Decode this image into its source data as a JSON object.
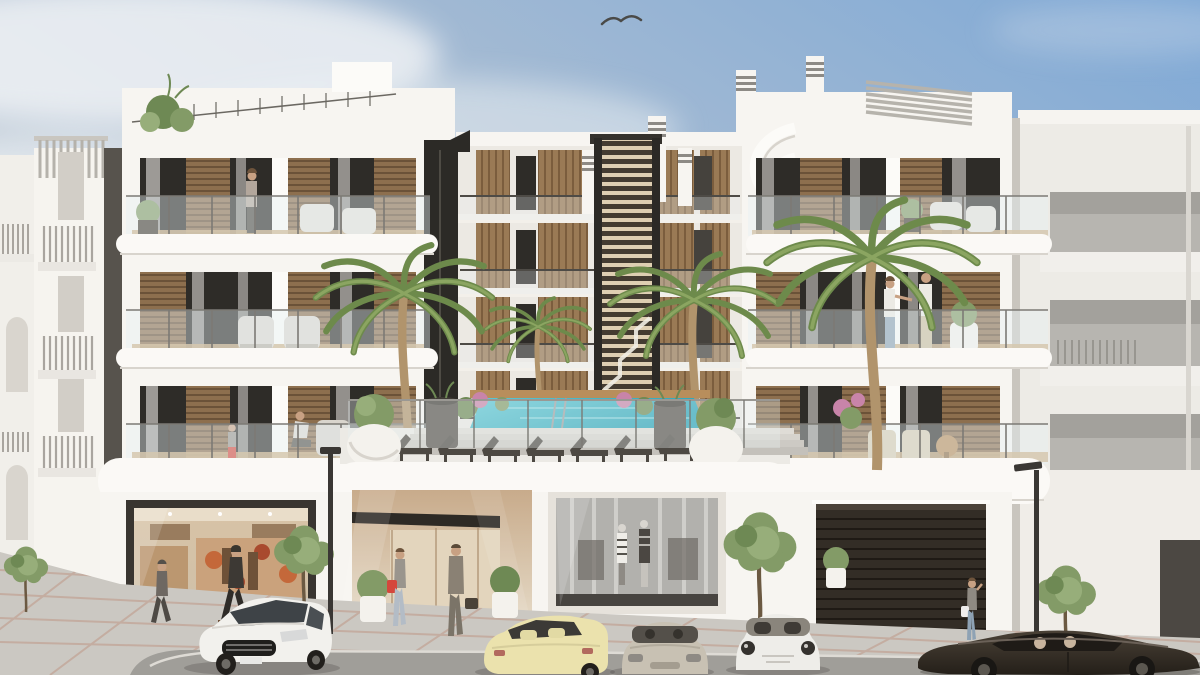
{
  "image": {
    "alt": "Architectural render: modern white four-storey apartment building with a central louvered stair tower, elevated pool courtyard with sun loungers, palm trees, ground-floor shops and garage, street with parked cars and pedestrians under a blue sky with one bird",
    "style": "photoreal exterior render",
    "bird_count": 1,
    "palm_count": 4,
    "street_tree_count": 4,
    "sun_lounger_count": 7,
    "lamp_post_count": 2
  },
  "objects": {
    "cars": [
      {
        "name": "white-hatchback",
        "color": "#f2f1ed"
      },
      {
        "name": "pale-yellow-convertible",
        "color": "#ebe2ad"
      },
      {
        "name": "beige-coupe",
        "color": "#c8c1b3"
      },
      {
        "name": "white-sports-car",
        "color": "#eeede9"
      },
      {
        "name": "dark-brown-sports-car",
        "color": "#39322b"
      }
    ],
    "ground_floor": [
      "boutique-shop",
      "lobby-passage",
      "fashion-storefront",
      "garage-door"
    ],
    "pedestrians_street": 5,
    "people_on_balconies": 5
  },
  "colors": {
    "sky_top": "#7fa9d6",
    "sky_mid": "#aebfd2",
    "sky_low": "#dde2e6",
    "cloud": "#eef1f4",
    "white_hi": "#fcfbf8",
    "white": "#f7f5f1",
    "white_warm": "#f3f0ea",
    "white_shade": "#e6e2db",
    "wall_shade": "#d8d4cd",
    "shadow_strip": "#57534d",
    "window": "#2e2c28",
    "window_light": "#45423d",
    "curtain": "#e7e4df",
    "louver": "#8d6f4e",
    "louver_dark": "#6b5238",
    "slat": "#9a7a55",
    "slat_dark": "#7b5d3d",
    "tower_slat": "#decfb2",
    "tower_bg": "#443c31",
    "frame_dark": "#2c2a26",
    "chimney_band": "#8d8a85",
    "glass": "#e8f0f2",
    "rail": "#7c7a75",
    "deck": "#c9aa7e",
    "fascia": "#fbf9f6",
    "pool_light": "#5ec9d5",
    "pool_deep": "#27a2b6",
    "pool_edge": "#b88e5c",
    "step": "#d4d1cb",
    "terrace": "#eceae5",
    "lounger": "#4d4943",
    "planter_white": "#f4f2ed",
    "planter_dark": "#56514a",
    "green": "#839b67",
    "green_light": "#97ae7a",
    "green_dark": "#6e8954",
    "palm": "#6d8a4b",
    "palm_light": "#8ba561",
    "trunk": "#b1946c",
    "tree_trunk": "#6b5942",
    "flower": "#c884a9",
    "shop_frame": "#393530",
    "shop_warm": "#d8c3a6",
    "shop_floor": "#cfc0a8",
    "shop_accent": "#c4683a",
    "shop_accent2": "#a94a2e",
    "passage_warm": "#c8ab8b",
    "passage_dark": "#2e2a25",
    "store_glass": "#b2b1ad",
    "store_mullion": "#d7d6d2",
    "store_base": "#474440",
    "garage": "#332d26",
    "garage_line": "#1f1a15",
    "pave": "#cbc8c2",
    "paver": "#ba8671",
    "road": "#a09e99",
    "curb": "#dedbd5",
    "lamp": "#3a3734",
    "skin": "#c8a183",
    "hair": "#6e543c",
    "red": "#d5473c",
    "denim": "#8ea2b4",
    "denim_light": "#b3bcc6",
    "suit": "#8a8174",
    "jacket": "#3d3934",
    "white_cloth": "#eceae4",
    "beige_pants": "#cbbd9e",
    "car_white": "#f2f1ed",
    "car_glass": "#3e4347",
    "car_yellow": "#ebe2ad",
    "car_beige": "#c8c1b3",
    "car_sport": "#eeede9",
    "car_dark": "#39322b",
    "car_dark2": "#241f19",
    "wheel": "#221f1c",
    "rim": "#6e6b66"
  }
}
